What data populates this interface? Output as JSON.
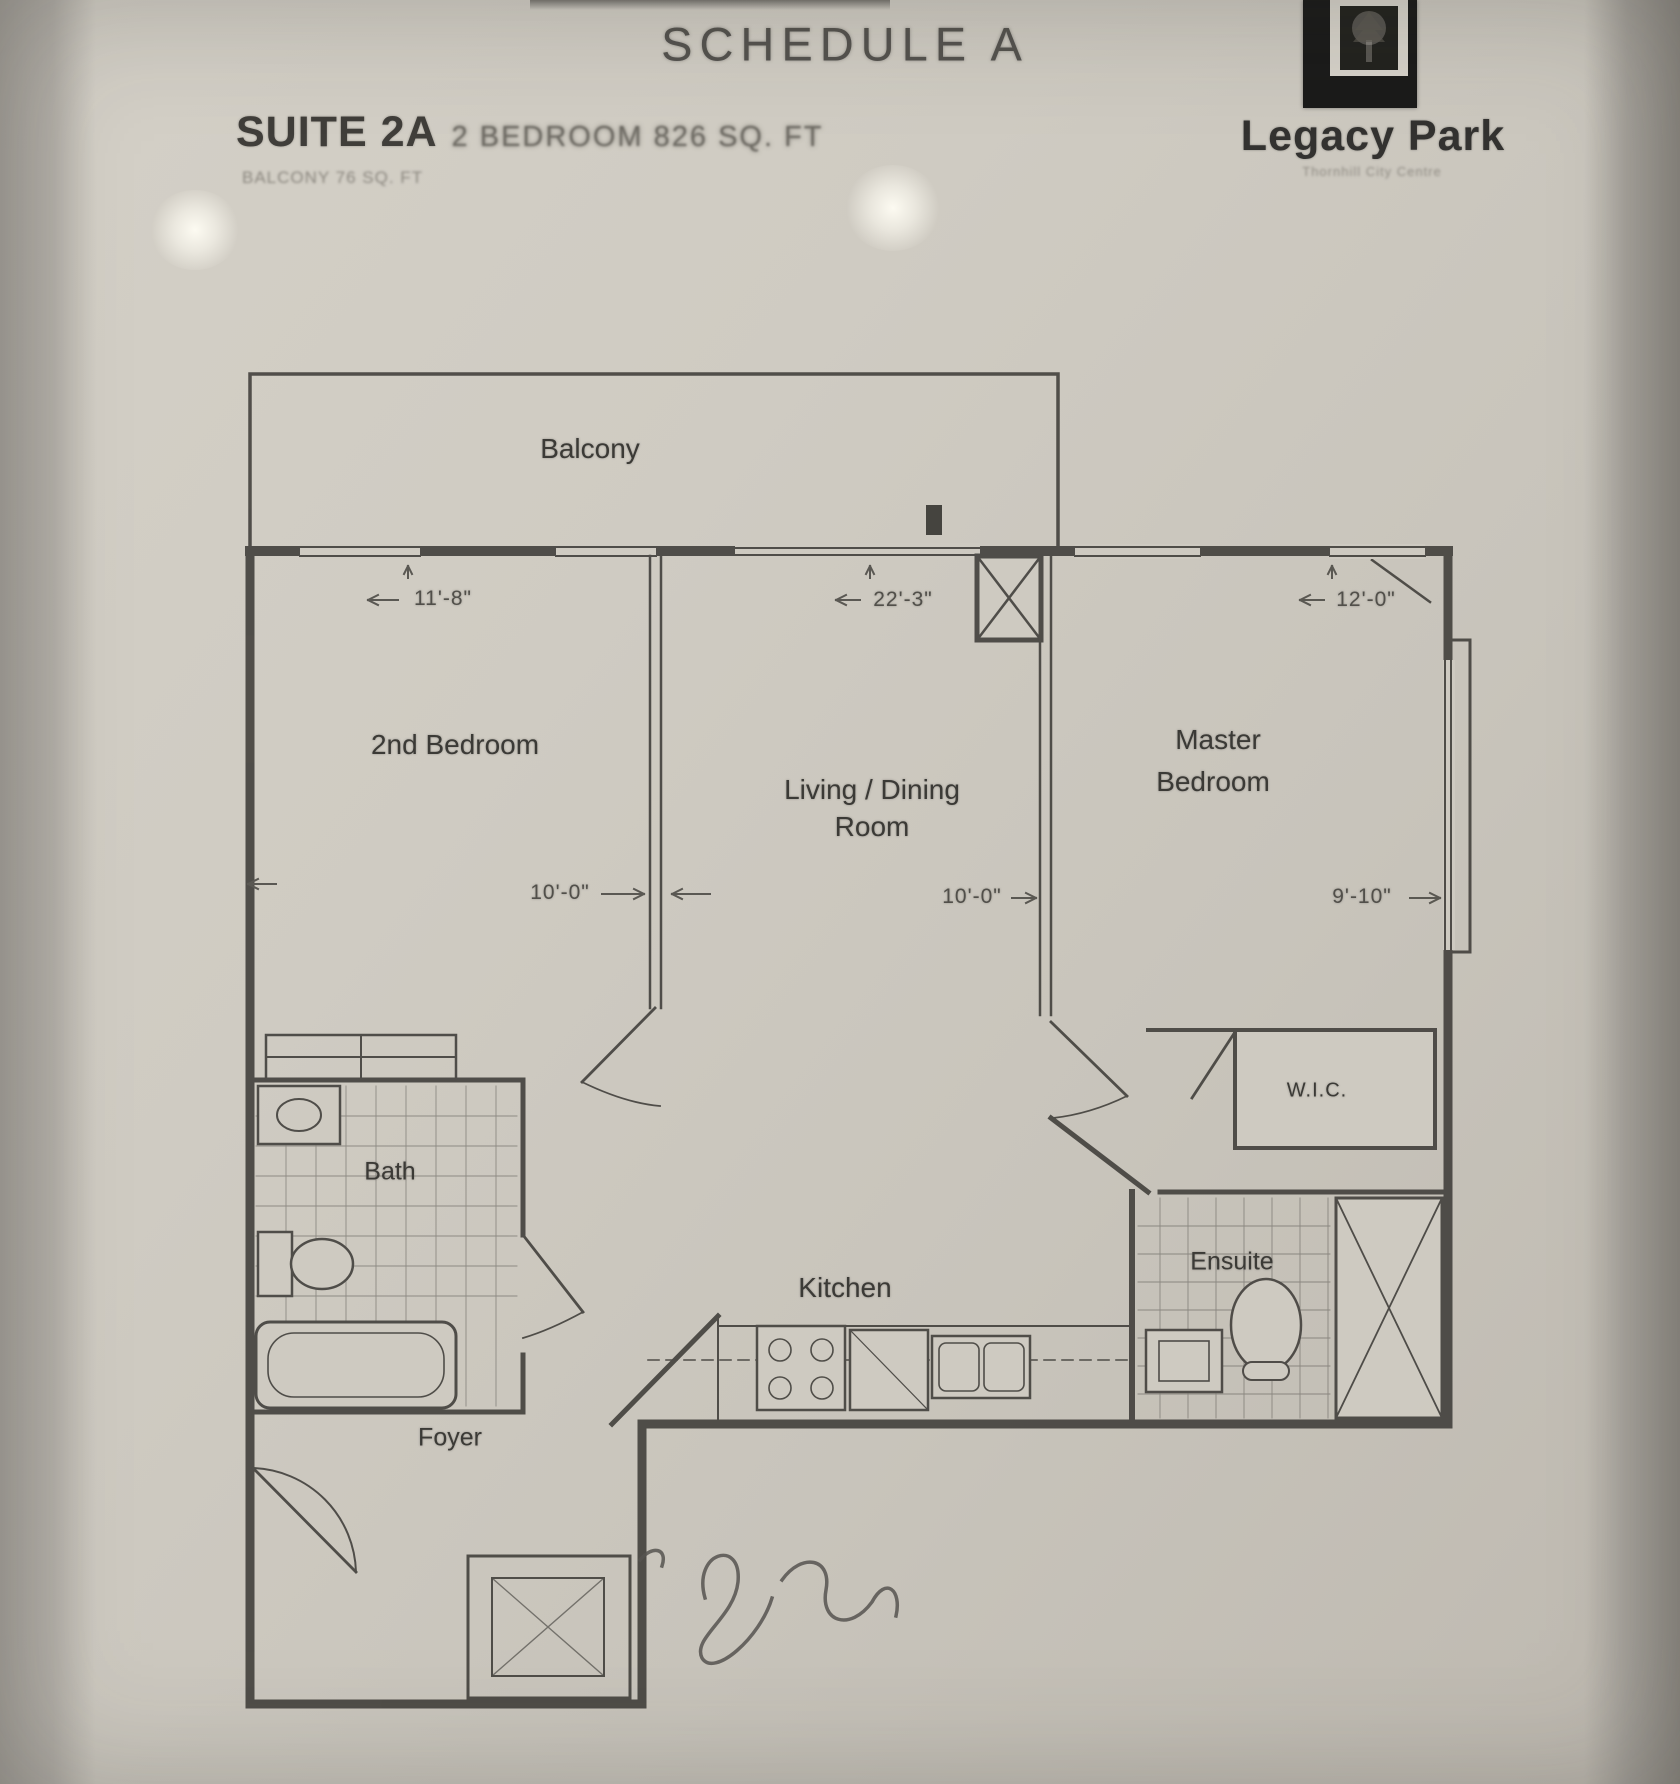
{
  "header": {
    "schedule_title": "SCHEDULE A",
    "suite_name": "SUITE 2A",
    "suite_details": "2 BEDROOM 826 SQ. FT",
    "suite_note": "BALCONY 76 SQ. FT",
    "brand_name": "Legacy Park",
    "brand_tagline": "Thornhill City Centre"
  },
  "rooms": {
    "balcony": "Balcony",
    "second_bedroom": "2nd Bedroom",
    "living_dining_line1": "Living / Dining",
    "living_dining_line2": "Room",
    "master_line1": "Master",
    "master_line2": "Bedroom",
    "wic": "W.I.C.",
    "bath": "Bath",
    "ensuite": "Ensuite",
    "kitchen": "Kitchen",
    "foyer": "Foyer"
  },
  "dimensions": {
    "second_bedroom_width": "11'-8\"",
    "living_width": "22'-3\"",
    "master_width": "12'-0\"",
    "second_bedroom_depth": "10'-0\"",
    "living_depth": "10'-0\"",
    "master_depth": "9'-10\""
  },
  "colors": {
    "ink": "#45433f",
    "paper": "#cfcbc2",
    "logo_black": "#1b1b1a"
  }
}
